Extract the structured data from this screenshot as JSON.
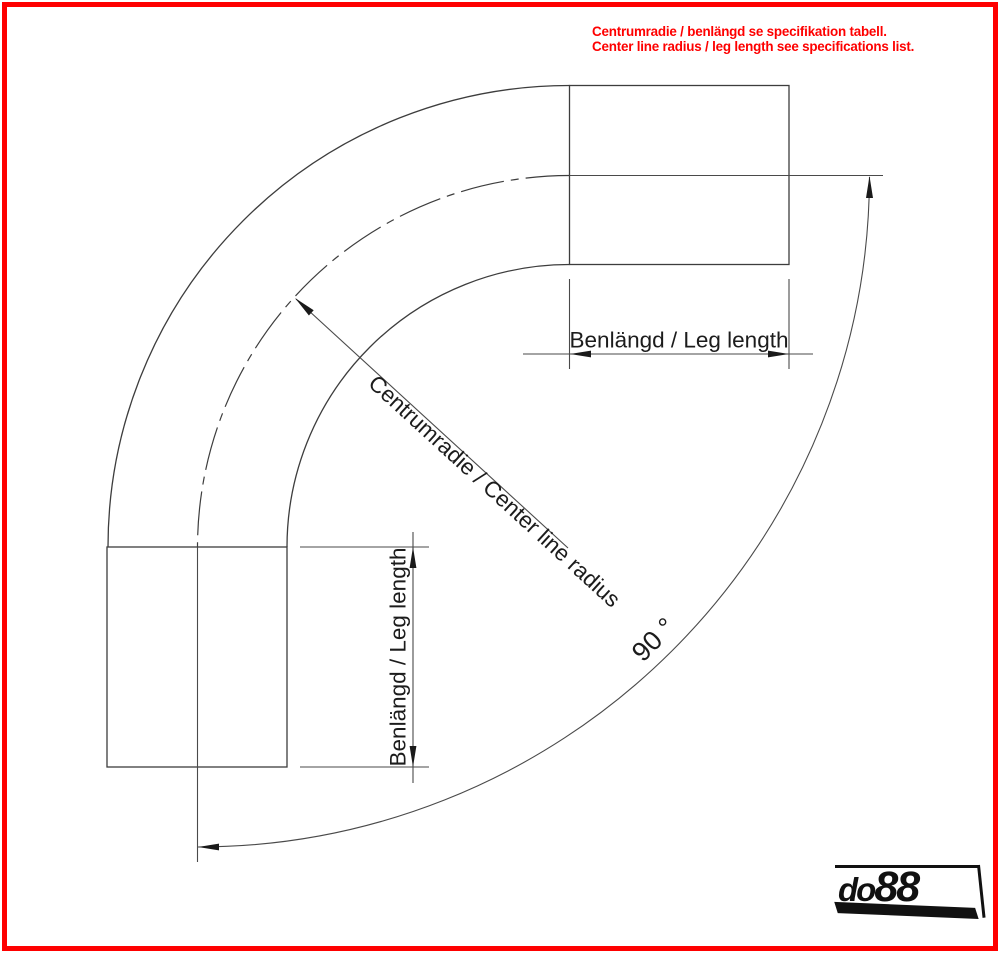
{
  "notice": {
    "line1": "Centrumradie / benlängd se specifikation tabell.",
    "line2": "Center line radius / leg length see specifications list.",
    "color": "#fe0000"
  },
  "dimensions": {
    "leg_top_label": "Benlängd / Leg length",
    "leg_left_label": "Benlängd / Leg length",
    "center_radius_label": "Centrumradie / Center line radius",
    "angle_label": "90 °"
  },
  "logo": {
    "part1": "do",
    "part2": "88"
  },
  "colors": {
    "border_red": "#fe0000",
    "line_gray": "#3d3d3d",
    "text_black": "#1c1c1c",
    "logo_black": "#111111"
  }
}
